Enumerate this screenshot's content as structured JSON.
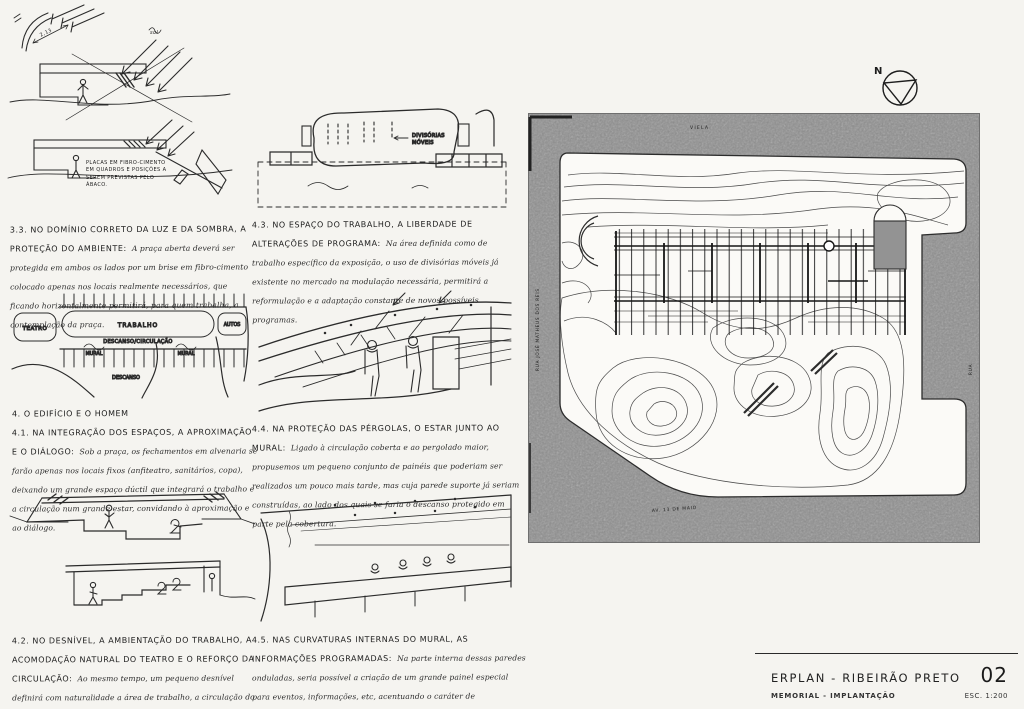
{
  "page": {
    "background": "#f5f4f0",
    "ink": "#222222",
    "street_gray": "#8e8e8e"
  },
  "notes": {
    "s33": {
      "heading": "3.3. NO DOMÍNIO CORRETO DA LUZ E DA SOMBRA, A PROTEÇÃO DO AMBIENTE:",
      "body": "A praça aberta deverá ser protegida em ambos os lados por um brise em fibro-cimento colocado apenas nos locais realmente necessários, que ficando horizontalmente permitirá, para quem trabalha, a contemplação da praça."
    },
    "s43": {
      "heading": "4.3. NO ESPAÇO DO TRABALHO, A LIBERDADE DE ALTERAÇÕES DE PROGRAMA:",
      "body": "Na área definida como de trabalho específico da exposição, o uso de divisórias móveis já existente no mercado na modulação necessária, permitirá a reformulação e a adaptação constante de novos possíveis programas."
    },
    "s4": {
      "heading": "4.  O EDIFÍCIO E O HOMEM"
    },
    "s41": {
      "heading": "4.1. NA INTEGRAÇÃO DOS ESPAÇOS, A APROXIMAÇÃO E O DIÁLOGO:",
      "body": "Sob a praça, os fechamentos em alvenaria se farão apenas nos locais fixos (anfiteatro, sanitários, copa), deixando um grande espaço dúctil que integrará o trabalho e a circulação num grande estar, convidando à aproximação e ao diálogo."
    },
    "s44": {
      "heading": "4.4. NA PROTEÇÃO DAS PÉRGOLAS, O ESTAR JUNTO AO MURAL:",
      "body": "Ligado à circulação coberta e ao pergolado maior, propusemos um pequeno conjunto de painéis que poderiam ser realizados um pouco mais tarde, mas cuja parede suporte já seriam construídas, ao lado dos quais se faria o descanso protegido em parte pela cobertura."
    },
    "s42": {
      "heading": "4.2. NO DESNÍVEL, A AMBIENTAÇÃO DO TRABALHO, A ACOMODAÇÃO NATURAL DO TEATRO E O REFORÇO DA CIRCULAÇÃO:",
      "body": "Ao mesmo tempo, um pequeno desnível definirá com naturalidade a área de trabalho, a circulação do público e a anatomia do teatro."
    },
    "s45": {
      "heading": "4.5. NAS CURVATURAS INTERNAS DO MURAL, AS INFORMAÇÕES PROGRAMADAS:",
      "body": "Na parte interna dessas paredes onduladas, seria possível a criação de um grande painel especial para eventos, informações, etc, acentuando o caráter de aproximação e diálogo."
    }
  },
  "sketch_labels": {
    "fibro_note": "PLACAS EM FIBRO-CIMENTO EM QUADROS E POSIÇÕES A SEREM PREVISTAS PELO ÁBACO.",
    "dim": "2,13",
    "sol": "sol",
    "teatro": "TEATRO",
    "trabalho": "TRABALHO",
    "autos": "AUTOS",
    "descanso_circulacao": "DESCANSO/CIRCULAÇÃO",
    "mural_left": "MURAL",
    "mural_right": "MURAL",
    "descanso": "DESCANSO",
    "divisorias_line1": "DIVISÓRIAS",
    "divisorias_line2": "MÓVEIS"
  },
  "site_plan": {
    "north_label": "N",
    "street_top": "VIELA",
    "street_left": "RUA JOSÉ MATHEUS DOS REIS",
    "street_bottom": "AV. 13 DE MAIO",
    "street_right": "RUA"
  },
  "title_block": {
    "project": "ERPLAN - RIBEIRÃO PRETO",
    "sheet_number": "02",
    "subtitle": "MEMORIAL - IMPLANTAÇÃO",
    "scale": "ESC. 1:200"
  }
}
